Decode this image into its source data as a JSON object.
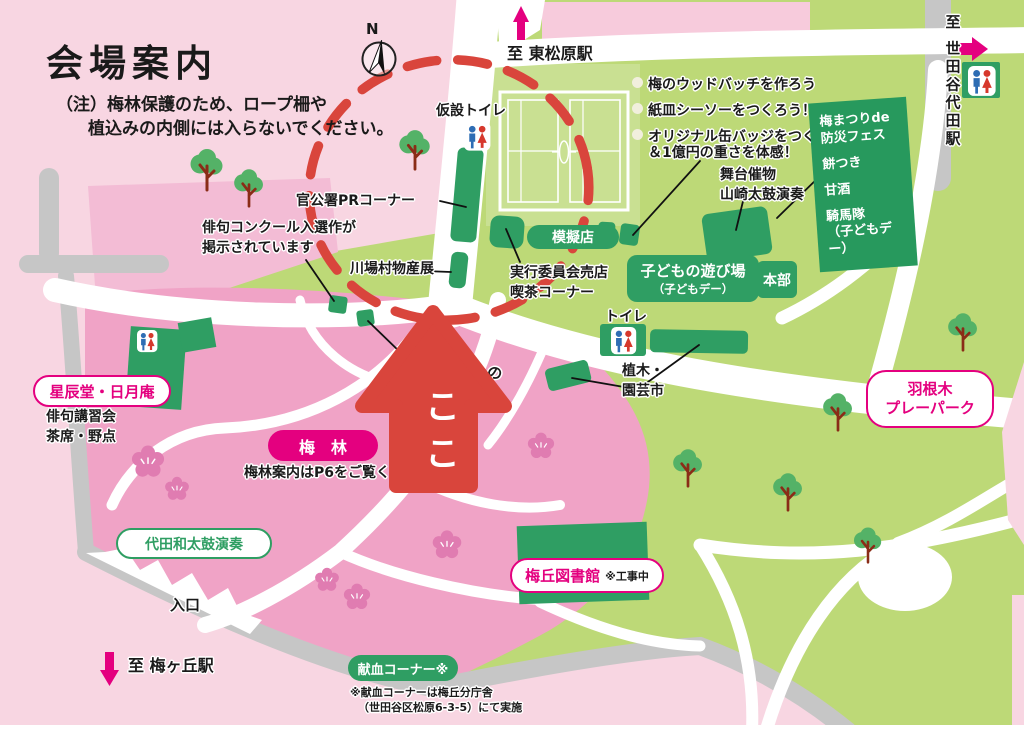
{
  "colors": {
    "accent_magenta": "#e4007f",
    "booth_green": "#2f9e63",
    "arrow_red": "#d9453c",
    "park_green": "#bdd977",
    "grove_pink": "#f0a3c6",
    "bg_pink": "#f8d6e2"
  },
  "header": {
    "title": "会場案内",
    "note_line1": "（注）梅林保護のため、ロープ柵や",
    "note_line2": "植込みの内側には入らないでください。",
    "compass": "N"
  },
  "stations": {
    "higashi_matsubara": "至 東松原駅",
    "setagaya_daita": "至 世田谷代田駅",
    "umegaoka": "至 梅ヶ丘駅"
  },
  "activities": {
    "item1": "梅のウッドバッチを作ろう",
    "item2": "紙皿シーソーをつくろう！",
    "item3": "オリジナル缶バッジをつくろう！",
    "item3b": "＆1億円の重さを体感！"
  },
  "stage": {
    "line1": "舞台催物",
    "line2": "山崎太鼓演奏"
  },
  "bousai_box": {
    "line1": "梅まつりde",
    "line2": "防災フェス",
    "line3": "餅つき",
    "line4": "甘酒",
    "line5": "騎馬隊",
    "line6": "（子どもデー）"
  },
  "booths": {
    "kasetsu_toilet": "仮設トイレ",
    "pr_corner": "官公署PRコーナー",
    "haiku_line1": "俳句コンクール入選作が",
    "haiku_line2": "掲示されています",
    "kawaba": "川場村物産展",
    "jikko_line1": "実行委員会売店",
    "jikko_line2": "喫茶コーナー",
    "mogiten": "模擬店",
    "kodomo_line1": "子どもの遊び場",
    "kodomo_line2": "（子どもデー）",
    "honbu": "本部",
    "toilet": "トイレ",
    "ueki_line1": "植木・",
    "ueki_line2": "園芸市"
  },
  "grove": {
    "seishindo": "星辰堂・日月庵",
    "haiku_class_line1": "俳句講習会",
    "haiku_class_line2": "茶席・野点",
    "bairin": "梅　林",
    "bairin_note": "梅林案内はP6をご覧ください",
    "koko": "ここ",
    "daita_taiko": "代田和太鼓演奏",
    "entrance": "入口",
    "road_fragment": "の"
  },
  "south": {
    "kenketsu": "献血コーナー※",
    "kenketsu_note1": "※献血コーナーは梅丘分庁舎",
    "kenketsu_note2": "（世田谷区松原6-3-5）にて実施"
  },
  "facilities": {
    "library": "梅丘図書館",
    "library_status": "※工事中",
    "hanegi_line1": "羽根木",
    "hanegi_line2": "プレーパーク"
  }
}
